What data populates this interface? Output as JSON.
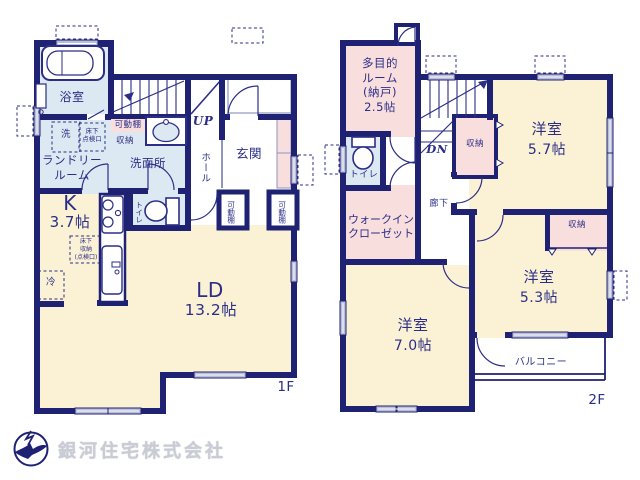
{
  "colors": {
    "wall": "#1f2173",
    "text_navy": "#2b2e87",
    "room_cream": "#fbf2d5",
    "room_pink": "#f9dede",
    "room_blue": "#dde9f2",
    "window_fill": "#b9bed9",
    "company_gray": "#c9ccd4"
  },
  "floor1": {
    "floor_label": "1F",
    "bath": "浴室",
    "laundry": "ランドリー\nルーム",
    "washer": "洗",
    "underfloor_hatch": "床下\n点検口",
    "movable_shelf": "可動棚",
    "storage": "収納",
    "washroom": "洗面所",
    "stairs_up": "UP",
    "hall": "ホール",
    "entrance": "玄関",
    "shelf_left": "可動棚",
    "shelf_right": "可動棚",
    "kitchen_name": "K",
    "kitchen_size": "3.7帖",
    "underfloor_storage": "床下\n収納\n(点検口)",
    "fridge": "冷",
    "toilet": "トイレ",
    "ld_name": "LD",
    "ld_size": "13.2帖"
  },
  "floor2": {
    "floor_label": "2F",
    "multi_room": "多目的\nルーム\n(納戸)\n2.5帖",
    "stairs_down": "DN",
    "toilet": "トイレ",
    "walk_in_closet": "ウォークイン\nクローゼット",
    "hallway": "廊下",
    "storage_stairs": "収納",
    "bedroom_57_name": "洋室",
    "bedroom_57_size": "5.7帖",
    "storage_53": "収納",
    "bedroom_53_name": "洋室",
    "bedroom_53_size": "5.3帖",
    "bedroom_70_name": "洋室",
    "bedroom_70_size": "7.0帖",
    "balcony": "バルコニー"
  },
  "branding": {
    "company": "銀河住宅株式会社"
  }
}
